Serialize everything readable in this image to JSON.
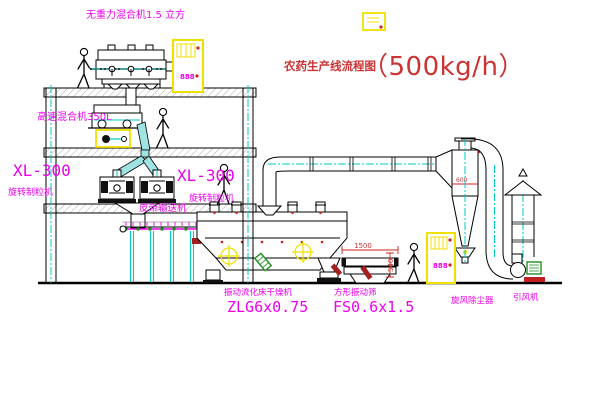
{
  "diagram": {
    "title": "农药生产线流程图",
    "title_capacity": "（500kg/h）"
  },
  "labels": {
    "gravity_mixer": "无重力混合机1.5 立方",
    "high_speed_mixer": "高速混合机350L",
    "granulator_left_model": "XL-300",
    "granulator_left": "旋转制粒机",
    "granulator_right_model": "XL-300",
    "granulator_right": "旋转制粒机",
    "belt_conveyor": "皮带输送机",
    "fluid_bed_dryer": "振动流化床干燥机",
    "fluid_bed_dryer_model": "ZLG6x0.75",
    "square_sieve": "方形振动筛",
    "square_sieve_model": "FS0.6x1.5",
    "cyclone": "旋风除尘器",
    "induced_draft_fan": "引风机"
  },
  "dimensions": {
    "sieve_length": "1500",
    "sieve_height": "540",
    "cyclone_note": "600"
  },
  "control_cabinet": {
    "display_top": "888",
    "display_right": "888"
  },
  "colors": {
    "line": "#000000",
    "label_magenta": "#ee00ee",
    "title_red": "#cc3333",
    "centerline_cyan": "#00c8c8",
    "cabinet_yellow": "#f0e000",
    "accent_red": "#cc2222",
    "motor_green": "#1f8f1f"
  }
}
